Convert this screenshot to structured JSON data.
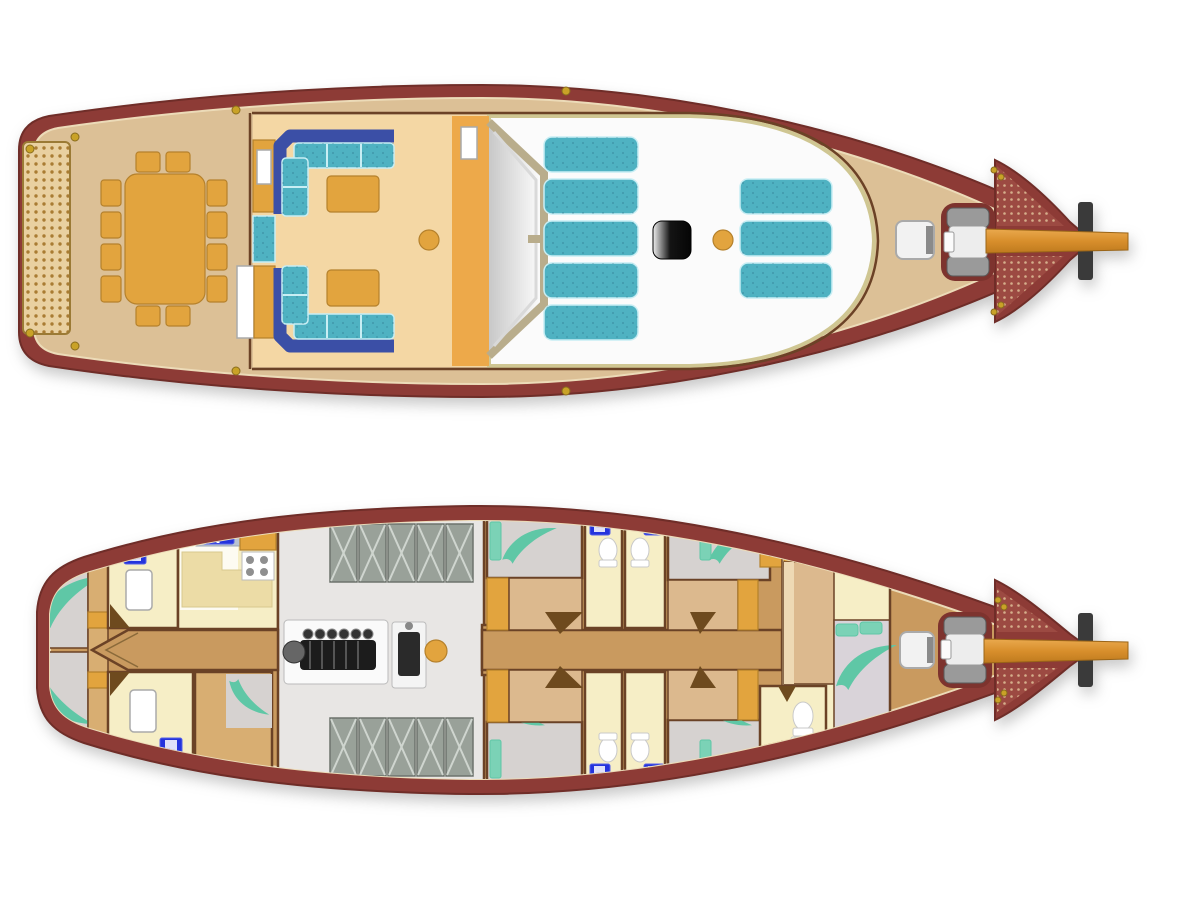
{
  "diagram": {
    "type": "boat-deck-plan",
    "subject": "two-deck sailing yacht (gulet) floor plan, bow pointing right",
    "decks": [
      {
        "id": "upper-deck",
        "features": [
          "stern-grating",
          "mooring-cleats",
          "dining-table",
          "dining-chairs",
          "bar-cabinets",
          "aft-salon-l-sofas",
          "coffee-tables",
          "companionway-trunk",
          "windshield",
          "deckhouse-roof",
          "sunpad-cushions-aft",
          "sunpad-cushions-fwd",
          "deck-hatch",
          "mast-foot",
          "foredeck-hatch",
          "anchor-windlass",
          "bow-netting",
          "bowsprit"
        ]
      },
      {
        "id": "lower-deck",
        "features": [
          "aft-cabin-port",
          "aft-cabin-starboard",
          "aft-bathrooms",
          "galley",
          "crew-cabin",
          "engine-room",
          "main-engine",
          "generator",
          "storage-lockers",
          "mast-foot",
          "corridor",
          "guest-cabins",
          "guest-bathrooms",
          "vip-cabin-forward",
          "vip-bathroom",
          "foredeck-hatch",
          "anchor-windlass",
          "bow-netting",
          "bowsprit"
        ]
      }
    ],
    "counts": {
      "decks": 2,
      "dining_chairs": 12,
      "aft_salon_sofas": 2,
      "coffee_tables": 2,
      "sunpad_cushions_aft_group": 5,
      "sunpad_cushions_fwd_group": 3,
      "aft_cabins": 2,
      "guest_cabins_midship": 4,
      "forward_cabins": 1,
      "bathrooms_lower_deck": 7,
      "engine_room_lockers": 10,
      "galley_stove_burners": 4
    }
  },
  "palette": {
    "bg": "#ffffff",
    "hull": "#8d3b36",
    "hullEdge": "#6f2d28",
    "deck": "#dcc096",
    "deckLine": "#ecdbb8",
    "wall": "#6b4226",
    "grate": "#e9d0a0",
    "grateDot": "#a97c33",
    "gold": "#c9a227",
    "goldEdge": "#8a6d1e",
    "orange": "#e2a43e",
    "orangeEdge": "#b5812c",
    "peach": "#f4d7a4",
    "trunk": "#eda94a",
    "sofaBack": "#3b4fa6",
    "cushion": "#4fb2c2",
    "cushionLine": "#c8eef4",
    "roof": "#fbfbfb",
    "roofRim": "#cfc692",
    "glassFrame": "#b9ad8c",
    "glassPane": "#d9d9d9",
    "hatchDark": "#141414",
    "windlass": "#7d332e",
    "machine": "#9a9a9a",
    "machineDark": "#5a5a5a",
    "net": "#9c4a42",
    "netDot": "#e0c098",
    "spritHi": "#eaa94e",
    "spritLo": "#bf7a1e",
    "spritBase": "#3a3a3a",
    "corridor": "#c99a5f",
    "roomTan": "#d8ae72",
    "bedTan": "#dcb98e",
    "bedLight": "#eed9b4",
    "cream": "#f6eec6",
    "creamWhite": "#fdfbf2",
    "grayFloor": "#d6d2d0",
    "lavender": "#d9d3d9",
    "engineFloor": "#e8e6e4",
    "locker": "#99a199",
    "lockerEdge": "#6d736d",
    "lockerLine": "#cfd5cf",
    "engineDark": "#1c1c1c",
    "plate": "#fafafa",
    "plant": "#5fc7a6",
    "pillow": "#7bd2b6",
    "sinkBlue": "#2433dd",
    "white": "#ffffff",
    "grayEdge": "#aaaaaa",
    "fold": "#6e4a1e",
    "khaki": "#ecdca6",
    "blueCounter": "#b9c3d2",
    "burner": "#8f8f8f"
  }
}
